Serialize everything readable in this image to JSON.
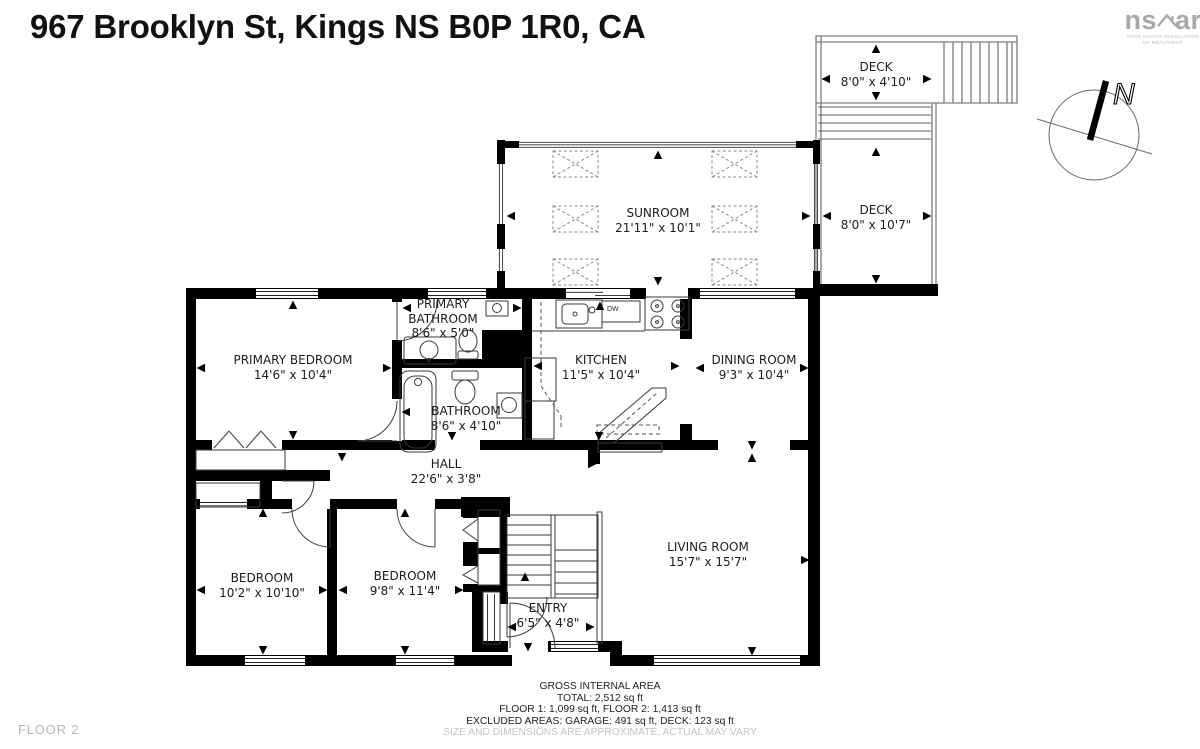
{
  "page": {
    "title": "967 Brooklyn St, Kings NS B0P 1R0, CA",
    "floor_label": "FLOOR 2"
  },
  "logo": {
    "part1": "ns",
    "part2": "ar",
    "caption1": "NOVA SCOTIA ASSOCIATION",
    "caption2": "OF REALTORS®"
  },
  "compass": {
    "north": "N"
  },
  "rooms": {
    "deck_top": {
      "label": "DECK",
      "dims": "8'0\" x 4'10\""
    },
    "deck_right": {
      "label": "DECK",
      "dims": "8'0\" x 10'7\""
    },
    "sunroom": {
      "label": "SUNROOM",
      "dims": "21'11\" x 10'1\""
    },
    "primary_bathroom": {
      "label": "PRIMARY BATHROOM",
      "dims": "8'6\" x 5'0\""
    },
    "primary_bedroom": {
      "label": "PRIMARY BEDROOM",
      "dims": "14'6\" x 10'4\""
    },
    "kitchen": {
      "label": "KITCHEN",
      "dims": "11'5\" x 10'4\""
    },
    "dining_room": {
      "label": "DINING ROOM",
      "dims": "9'3\" x 10'4\""
    },
    "bathroom": {
      "label": "BATHROOM",
      "dims": "8'6\" x 4'10\""
    },
    "hall": {
      "label": "HALL",
      "dims": "22'6\" x 3'8\""
    },
    "bedroom_left": {
      "label": "BEDROOM",
      "dims": "10'2\" x 10'10\""
    },
    "bedroom_middle": {
      "label": "BEDROOM",
      "dims": "9'8\" x 11'4\""
    },
    "entry": {
      "label": "ENTRY",
      "dims": "6'5\" x 4'8\""
    },
    "living_room": {
      "label": "LIVING ROOM",
      "dims": "15'7\" x 15'7\""
    }
  },
  "fixtures": {
    "dishwasher": "DW"
  },
  "footer": {
    "line1": "GROSS INTERNAL AREA",
    "line2": "TOTAL: 2,512 sq ft",
    "line3": "FLOOR 1: 1,099 sq ft, FLOOR 2: 1,413 sq ft",
    "line4": "EXCLUDED AREAS: GARAGE: 491 sq ft, DECK: 123 sq ft",
    "line5": "SIZE AND DIMENSIONS ARE APPROXIMATE, ACTUAL MAY VARY"
  },
  "colors": {
    "wall": "#000000",
    "thin_line": "#3a3a3a",
    "deck_line": "#7d7d7d",
    "muted_text": "#c4c4c4",
    "logo_gray": "#a8a8ac"
  }
}
